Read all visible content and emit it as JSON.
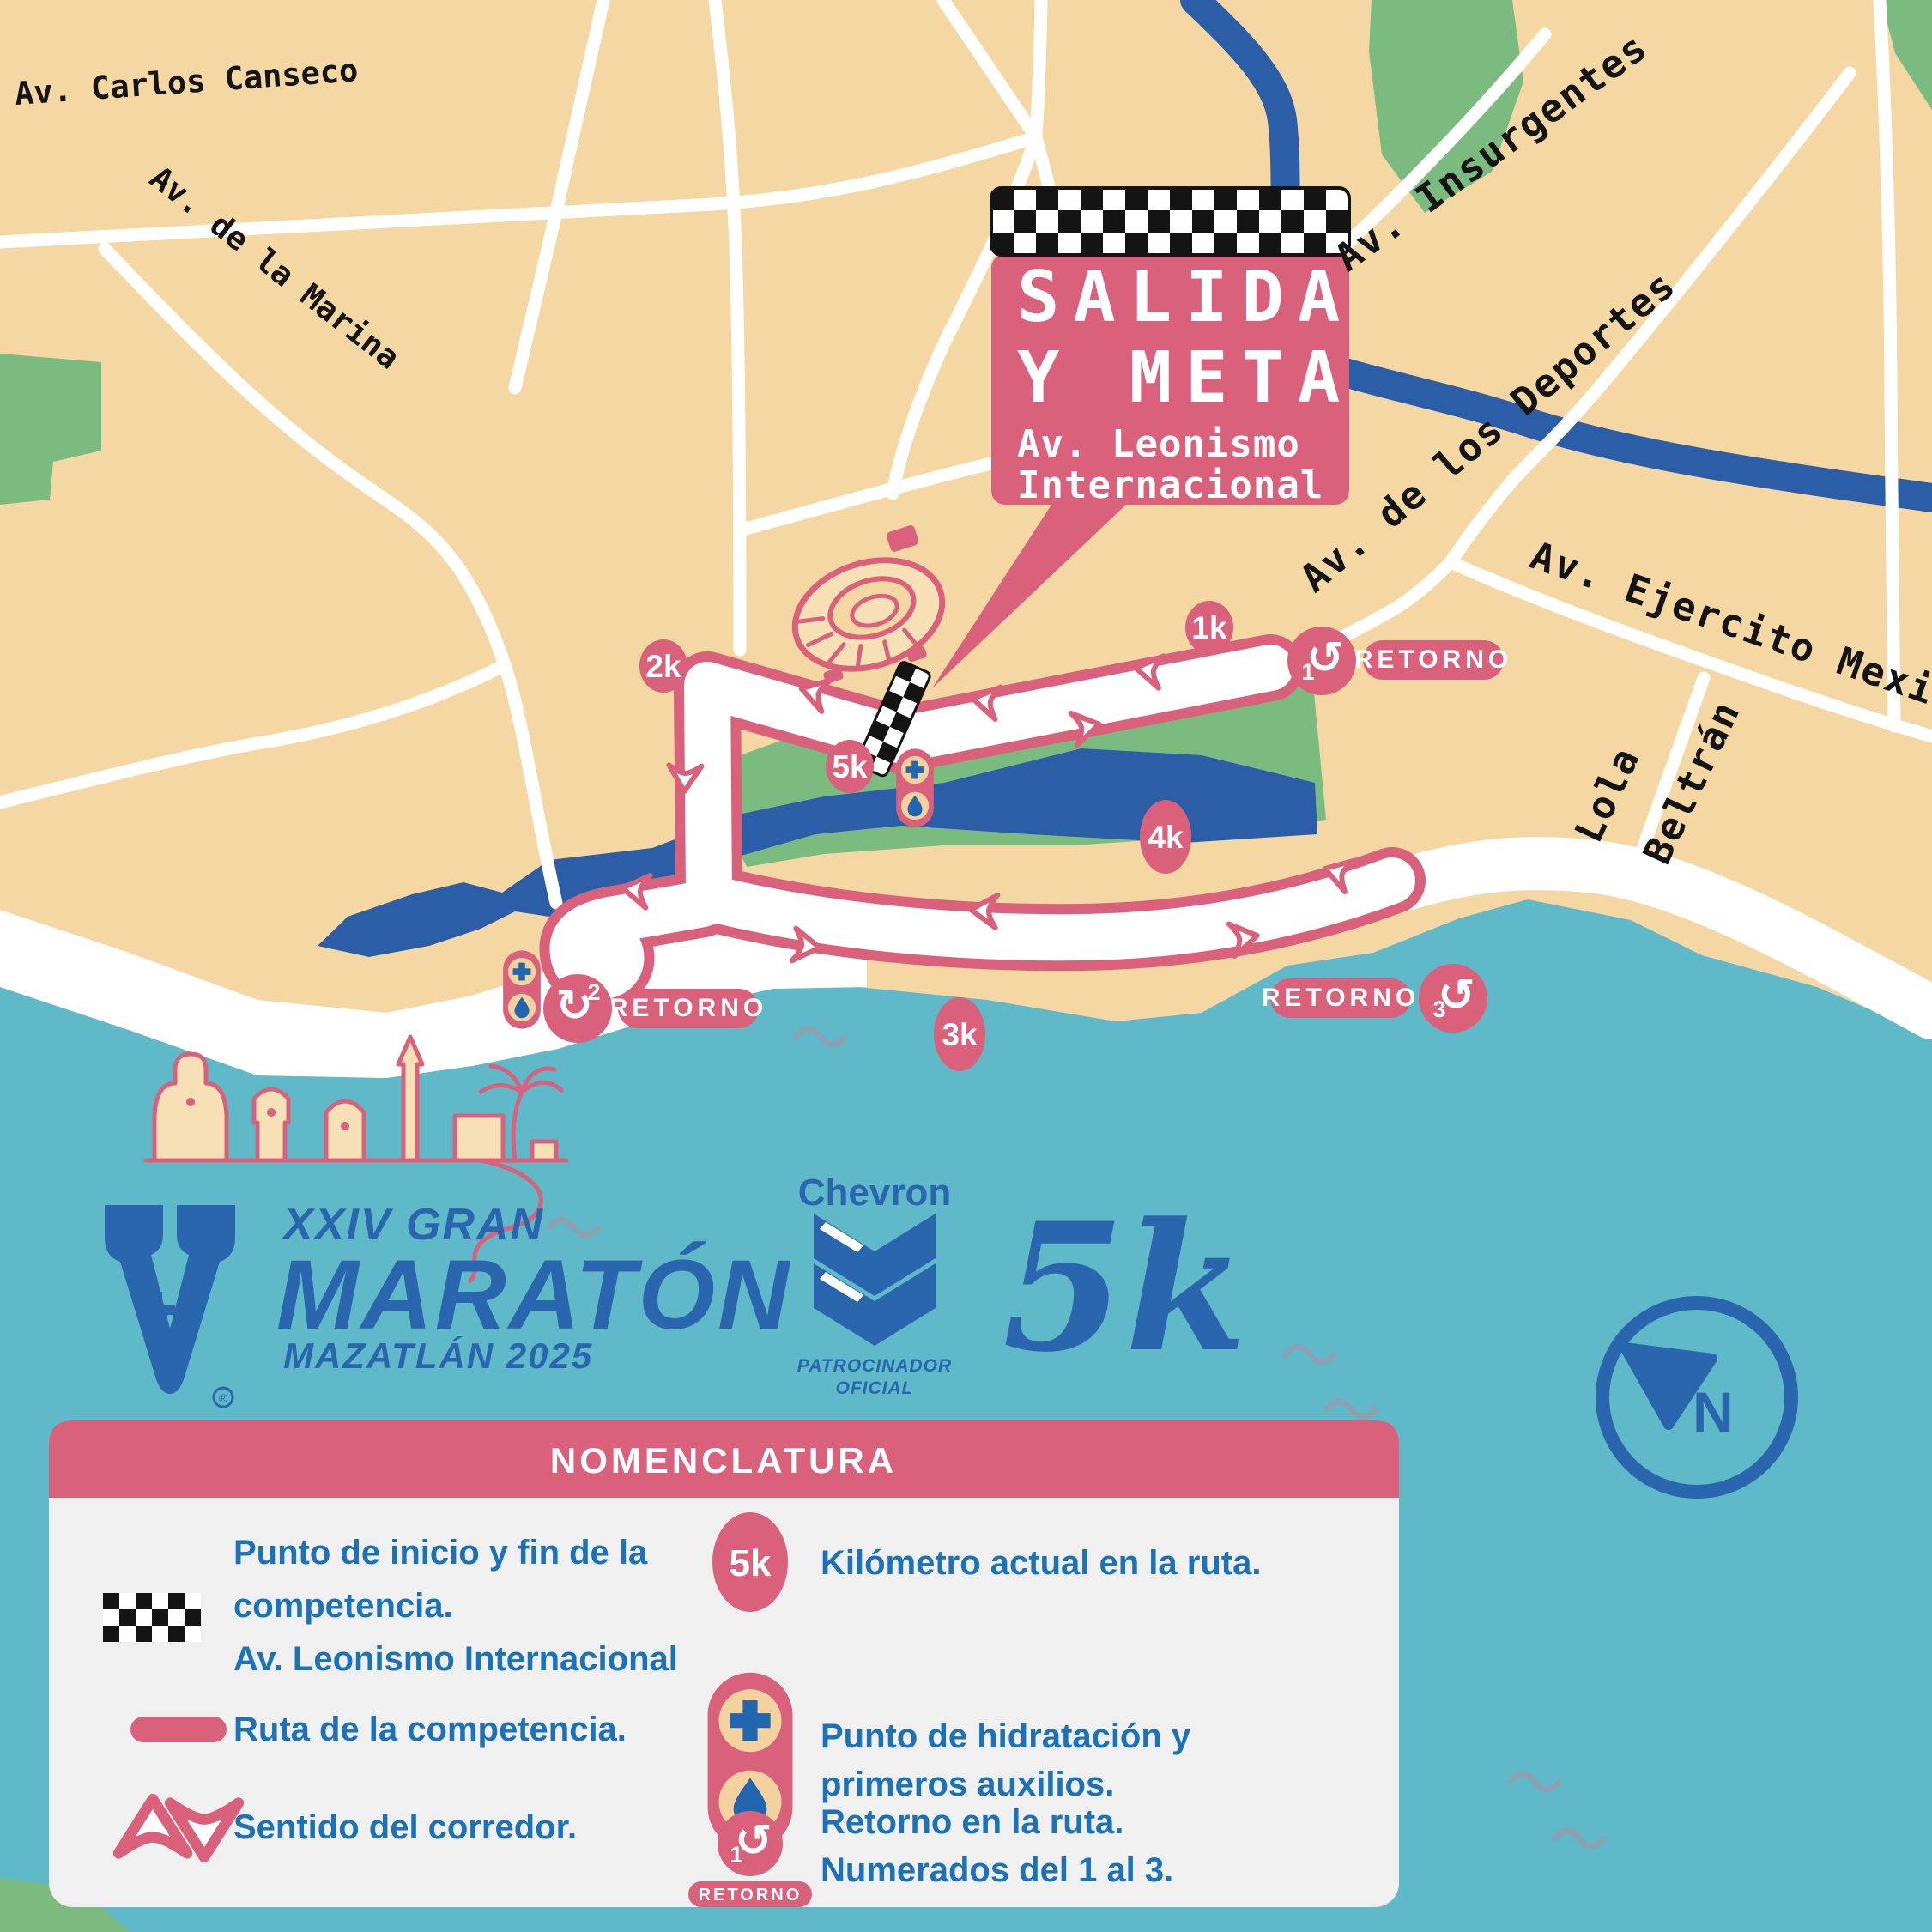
{
  "map": {
    "streets": {
      "carlos_canseco": "Av. Carlos Canseco",
      "de_la_marina": "Av. de la Marina",
      "insurgentes": "Av. Insurgentes",
      "de_los_deportes": "Av. de los Deportes",
      "ejercito_mexicano": "Av. Ejercito Mexicano",
      "lola": "Lola",
      "beltran": "Beltrán"
    },
    "callout": {
      "line1": "SALIDA",
      "line2": "Y META",
      "line3": "Av. Leonismo",
      "line4": "Internacional"
    },
    "km_markers": {
      "k1": "1k",
      "k2": "2k",
      "k3": "3k",
      "k4": "4k",
      "k5": "5k"
    },
    "retorno_label": "RETORNO",
    "retorno_numbers": {
      "r1": "1",
      "r2": "2",
      "r3": "3"
    },
    "compass": "N"
  },
  "branding": {
    "series": "XXIV GRAN",
    "title": "MARATÓN",
    "location": "MAZATLÁN 2025",
    "trademark": "®",
    "sponsor": "Chevron",
    "sponsor_line1": "PATROCINADOR",
    "sponsor_line2": "OFICIAL",
    "distance": "5k"
  },
  "legend": {
    "title": "NOMENCLATURA",
    "start_line1": "Punto de inicio y fin de la",
    "start_line2": "competencia.",
    "start_line3": "Av. Leonismo Internacional",
    "route": "Ruta de la competencia.",
    "direction": "Sentido del corredor.",
    "km": "Kilómetro actual en la ruta.",
    "km_badge": "5k",
    "hydration_line1": "Punto de hidratación y",
    "hydration_line2": "primeros auxilios.",
    "retorno_line1": "Retorno en la ruta.",
    "retorno_line2": "Numerados del 1 al 3.",
    "retorno_number": "1",
    "retorno_badge": "RETORNO"
  },
  "colors": {
    "route_pink": "#D9617B",
    "ocean": "#5FB9C8",
    "land": "#F5D7A4",
    "park": "#7CBB80",
    "water_blue": "#2B5EA7",
    "brand_blue": "#2A66AD",
    "legend_text_blue": "#1B72B8",
    "panel_gray": "#F0F0F0"
  }
}
